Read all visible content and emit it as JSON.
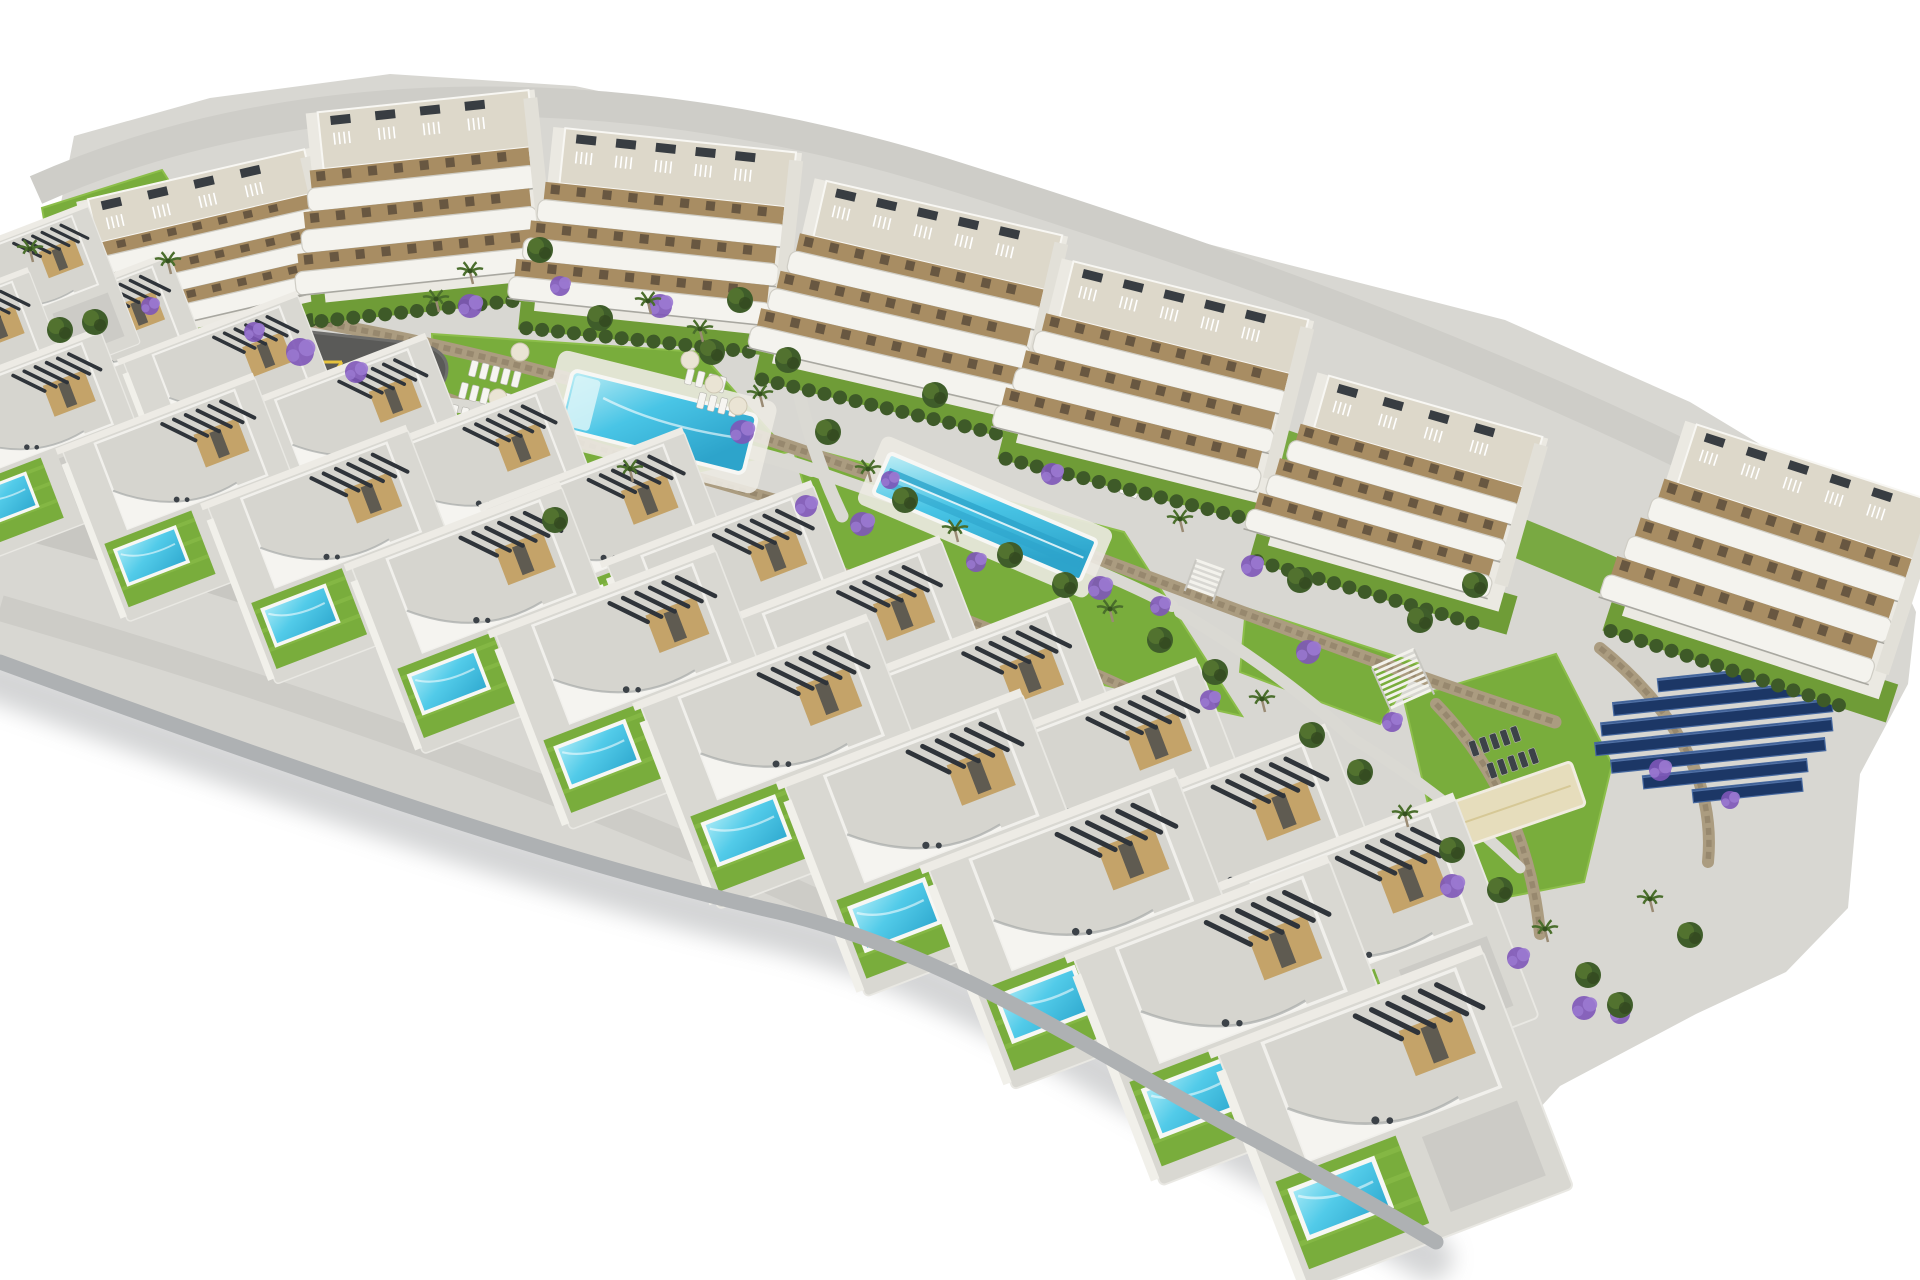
{
  "scene": {
    "width": 1920,
    "height": 1280,
    "background": "#ffffff",
    "subject": "aerial-3d-render-residential-development"
  },
  "palette": {
    "base": "#d8d7d2",
    "road": "#c8c7c2",
    "roadTop": "#cecdc8",
    "cliff": "#aeb1b3",
    "shadow": "#8f9294",
    "lawn": "#79ad3c",
    "lawnLight": "#8cbe4a",
    "lawnBand": "#74a73a",
    "hedge": "#3e5a28",
    "tree1": "#3f5d2a",
    "tree2": "#547430",
    "palm": "#4a6e2c",
    "trunk": "#9a8b74",
    "wall": "#ab9c80",
    "wallDark": "#8f8066",
    "poolRim": "#f7f7f4",
    "poolDeep": "#2da4cb",
    "purple1": "#7e57b8",
    "purple2": "#9b79d2",
    "solar": "#1c3766",
    "solarEdge": "#46689f",
    "aptWhite": "#f4f3ee",
    "terraceTan": "#a88d63",
    "roofBeige": "#ddd8ca",
    "units": "#383d42",
    "villaRoof": "#d6d5cf",
    "concrete": "#d9d8d2",
    "tan": "#c4a369",
    "pergola": "#2f343a",
    "deck": "#eceae2",
    "sand": "#e6ddbc",
    "playground": "#5a5a58",
    "playEquip": "#e6c33e"
  },
  "site": {
    "base_path": "M 0,258 L 58,218 L 74,136 L 210,98 L 390,74 L 575,86 L 790,132 L 1030,198 L 1270,260 L 1505,320 L 1690,402 L 1806,472 L 1884,542 L 1916,612 L 1908,684 L 1860,774 L 1848,908 L 1786,972 L 1696,1014 L 1560,1086 L 1470,1184 L 1436,1242 C 1396,1218 1330,1180 1252,1138 C 1108,1062 958,955 778,912 C 560,862 300,772 0,662 Z",
    "front_edge_path": "M 0,662 C 300,772 560,862 778,912 C 958,955 1108,1062 1252,1138 C 1330,1180 1396,1218 1436,1242",
    "top_road_path": "M 36,190 C 300,72 640,76 960,178 C 1260,272 1580,386 1896,566",
    "mid_road_path": "M 0,512 C 340,600 680,728 1000,894 C 1190,993 1320,1080 1418,1162",
    "front_road_path": "M 0,608 C 320,700 640,814 932,956 C 1128,1052 1298,1148 1410,1224",
    "garden_band_path": "M 60,252 C 340,218 640,252 950,330 C 1240,402 1520,508 1800,640 L 1840,706 C 1560,564 1260,452 960,372 C 660,292 360,260 92,298 Z"
  },
  "greens": [
    {
      "d": "M 42,208 L 162,170 L 212,248 L 158,312 L 58,300 Z"
    },
    {
      "d": "M 432,334 L 700,352 L 788,452 L 560,502 L 436,428 Z"
    },
    {
      "d": "M 792,444 L 1124,532 L 1242,716 L 1010,664 L 824,556 Z"
    },
    {
      "d": "M 1404,700 L 1556,654 L 1612,764 L 1584,882 L 1452,908 Z"
    },
    {
      "d": "M 1302,1122 L 1402,1078 L 1434,1180 L 1434,1240 L 1356,1192 Z"
    },
    {
      "d": "M 1246,608 L 1420,664 L 1380,724 L 1240,672 Z"
    }
  ],
  "walls": [
    {
      "d": "M 148,296 C 420,330 640,392 880,478 C 1120,564 1330,650 1555,722",
      "w": 13
    },
    {
      "d": "M 430,392 C 540,432 660,468 792,504",
      "w": 11
    },
    {
      "d": "M 806,560 C 950,610 1090,668 1215,730",
      "w": 11
    },
    {
      "d": "M 842,610 C 980,662 1110,715 1228,772",
      "w": 10
    },
    {
      "d": "M 1436,704 C 1500,770 1532,850 1540,934",
      "w": 12
    },
    {
      "d": "M 1600,648 C 1672,706 1716,780 1708,862",
      "w": 12
    }
  ],
  "paths": [
    {
      "d": "M 352,392 C 540,418 690,428 812,470",
      "w": 14
    },
    {
      "d": "M 812,470 C 940,516 1060,548 1172,606",
      "w": 12
    },
    {
      "d": "M 792,356 C 800,408 816,462 842,516",
      "w": 13
    },
    {
      "d": "M 1180,612 C 1240,648 1300,690 1352,738",
      "w": 12
    },
    {
      "d": "M 1352,738 C 1420,780 1470,820 1520,868",
      "w": 11
    }
  ],
  "apartments": [
    {
      "cx": 210,
      "cy": 248,
      "w": 240,
      "h": 150,
      "rot": -13
    },
    {
      "cx": 430,
      "cy": 196,
      "w": 230,
      "h": 190,
      "rot": -6
    },
    {
      "cx": 668,
      "cy": 232,
      "w": 250,
      "h": 185,
      "rot": 6
    },
    {
      "cx": 920,
      "cy": 300,
      "w": 260,
      "h": 190,
      "rot": 13
    },
    {
      "cx": 1165,
      "cy": 382,
      "w": 260,
      "h": 190,
      "rot": 14
    },
    {
      "cx": 1408,
      "cy": 492,
      "w": 240,
      "h": 180,
      "rot": 16
    },
    {
      "cx": 1782,
      "cy": 560,
      "w": 270,
      "h": 205,
      "rot": 18
    }
  ],
  "villas": {
    "rowA": [
      {
        "x": 105,
        "y": 355,
        "s": 0.84,
        "rot": -21,
        "car": null
      },
      {
        "x": 230,
        "y": 399,
        "s": 0.88,
        "rot": -21,
        "car": "#d9dadb"
      },
      {
        "x": 356,
        "y": 446,
        "s": 0.92,
        "rot": -21,
        "car": null
      },
      {
        "x": 482,
        "y": 496,
        "s": 0.96,
        "rot": -21,
        "car": "#3a424d"
      },
      {
        "x": 607,
        "y": 550,
        "s": 1.0,
        "rot": -21,
        "car": null
      },
      {
        "x": 733,
        "y": 608,
        "s": 1.04,
        "rot": -21,
        "car": "#6b4a33"
      },
      {
        "x": 858,
        "y": 668,
        "s": 1.08,
        "rot": -21,
        "car": null
      },
      {
        "x": 984,
        "y": 732,
        "s": 1.12,
        "rot": -21,
        "car": "#d9dadb"
      },
      {
        "x": 1109,
        "y": 800,
        "s": 1.16,
        "rot": -21,
        "car": null
      },
      {
        "x": 1235,
        "y": 871,
        "s": 1.2,
        "rot": -21,
        "car": "#2e3742"
      },
      {
        "x": 1360,
        "y": 945,
        "s": 1.24,
        "rot": -21,
        "car": null
      }
    ],
    "rowB": [
      {
        "x": 30,
        "y": 440,
        "s": 0.92,
        "rot": -21,
        "car": "#d9dadb"
      },
      {
        "x": 180,
        "y": 492,
        "s": 0.97,
        "rot": -21,
        "car": null
      },
      {
        "x": 330,
        "y": 549,
        "s": 1.01,
        "rot": -21,
        "car": "#dcdddd"
      },
      {
        "x": 480,
        "y": 612,
        "s": 1.06,
        "rot": -21,
        "car": null
      },
      {
        "x": 630,
        "y": 681,
        "s": 1.11,
        "rot": -21,
        "car": "#3a424d"
      },
      {
        "x": 780,
        "y": 755,
        "s": 1.15,
        "rot": -21,
        "car": null
      },
      {
        "x": 930,
        "y": 836,
        "s": 1.2,
        "rot": -21,
        "car": "#d9dadb"
      },
      {
        "x": 1080,
        "y": 922,
        "s": 1.25,
        "rot": -21,
        "car": null
      },
      {
        "x": 1230,
        "y": 1013,
        "s": 1.29,
        "rot": -21,
        "car": "#6b4a33"
      },
      {
        "x": 1380,
        "y": 1110,
        "s": 1.34,
        "rot": -21,
        "car": null
      }
    ],
    "extra": [
      {
        "x": 28,
        "y": 298,
        "s": 0.78,
        "rot": -21,
        "car": null
      },
      {
        "x": -34,
        "y": 368,
        "s": 0.82,
        "rot": -21,
        "car": null
      }
    ]
  },
  "pools": {
    "main": {
      "cx": 658,
      "cy": 422,
      "rot": 14,
      "deckW": 225,
      "deckH": 95,
      "poolW": 190,
      "poolH": 60
    },
    "lap": {
      "cx": 985,
      "cy": 517,
      "rot": 23,
      "deckW": 250,
      "deckH": 74,
      "poolW": 225,
      "poolH": 44
    }
  },
  "solar": {
    "x": 1722,
    "y": 672,
    "rot": -6,
    "rowH": 13,
    "rowGap": 19,
    "lens": [
      140,
      205,
      232,
      238,
      215,
      165,
      110
    ],
    "offs": [
      55,
      8,
      -6,
      -14,
      0,
      30,
      78
    ]
  },
  "playground": {
    "blob": "M 245,355 Q 250,333 292,330 L 420,344 Q 452,352 446,376 Q 436,406 378,408 L 284,398 Q 248,390 245,355 Z",
    "sand": {
      "x": 262,
      "y": 349,
      "w": 42,
      "h": 14,
      "rot": -8
    }
  },
  "petanque": {
    "cx": 1512,
    "cy": 806,
    "w": 140,
    "h": 46,
    "rot": -19
  },
  "stairs": [
    {
      "x": 1372,
      "y": 668,
      "rot": -24,
      "steps": 9,
      "len": 46
    },
    {
      "x": 1196,
      "y": 560,
      "rot": 20,
      "steps": 6,
      "len": 30
    }
  ],
  "loungers": [
    {
      "x": 472,
      "y": 360,
      "rot": 14,
      "count": 5,
      "dark": false
    },
    {
      "x": 462,
      "y": 382,
      "rot": 14,
      "count": 5,
      "dark": false
    },
    {
      "x": 452,
      "y": 404,
      "rot": 14,
      "count": 4,
      "dark": false
    },
    {
      "x": 688,
      "y": 368,
      "rot": 14,
      "count": 4,
      "dark": false
    },
    {
      "x": 700,
      "y": 392,
      "rot": 14,
      "count": 4,
      "dark": false
    },
    {
      "x": 1086,
      "y": 448,
      "rot": 20,
      "count": 4,
      "dark": false
    },
    {
      "x": 1104,
      "y": 470,
      "rot": 20,
      "count": 4,
      "dark": false
    },
    {
      "x": 1468,
      "y": 742,
      "rot": -19,
      "count": 5,
      "dark": true
    },
    {
      "x": 1486,
      "y": 764,
      "rot": -19,
      "count": 5,
      "dark": true
    }
  ],
  "parasols": [
    [
      690,
      360
    ],
    [
      714,
      384
    ],
    [
      738,
      406
    ],
    [
      520,
      352
    ],
    [
      498,
      398
    ]
  ],
  "flowers": [
    [
      300,
      352,
      14
    ],
    [
      356,
      372,
      11
    ],
    [
      254,
      332,
      10
    ],
    [
      470,
      306,
      12
    ],
    [
      560,
      286,
      10
    ],
    [
      660,
      306,
      12
    ],
    [
      742,
      432,
      12
    ],
    [
      806,
      506,
      11
    ],
    [
      862,
      524,
      12
    ],
    [
      1052,
      474,
      11
    ],
    [
      1100,
      588,
      12
    ],
    [
      1160,
      606,
      10
    ],
    [
      1252,
      566,
      11
    ],
    [
      1308,
      652,
      12
    ],
    [
      1392,
      722,
      10
    ],
    [
      1452,
      886,
      12
    ],
    [
      1518,
      958,
      11
    ],
    [
      1584,
      1008,
      12
    ],
    [
      976,
      562,
      10
    ],
    [
      890,
      480,
      9
    ],
    [
      1210,
      700,
      10
    ],
    [
      1620,
      1014,
      10
    ],
    [
      150,
      306,
      9
    ],
    [
      1660,
      770,
      11
    ],
    [
      1730,
      800,
      9
    ]
  ],
  "trees": [
    [
      168,
      262,
      "p"
    ],
    [
      95,
      322,
      "t"
    ],
    [
      60,
      330,
      "t"
    ],
    [
      30,
      250,
      "p"
    ],
    [
      436,
      300,
      "p"
    ],
    [
      470,
      272,
      "p"
    ],
    [
      540,
      250,
      "t"
    ],
    [
      600,
      318,
      "t"
    ],
    [
      648,
      302,
      "p"
    ],
    [
      700,
      330,
      "p"
    ],
    [
      712,
      352,
      "t"
    ],
    [
      760,
      395,
      "p"
    ],
    [
      788,
      360,
      "t"
    ],
    [
      828,
      432,
      "t"
    ],
    [
      868,
      470,
      "p"
    ],
    [
      905,
      500,
      "t"
    ],
    [
      955,
      530,
      "p"
    ],
    [
      1010,
      555,
      "t"
    ],
    [
      1065,
      585,
      "t"
    ],
    [
      1110,
      610,
      "p"
    ],
    [
      1160,
      640,
      "t"
    ],
    [
      1215,
      672,
      "t"
    ],
    [
      1262,
      700,
      "p"
    ],
    [
      1312,
      735,
      "t"
    ],
    [
      1360,
      772,
      "t"
    ],
    [
      1405,
      815,
      "p"
    ],
    [
      1452,
      850,
      "t"
    ],
    [
      1500,
      890,
      "t"
    ],
    [
      1545,
      930,
      "p"
    ],
    [
      1588,
      975,
      "t"
    ],
    [
      1620,
      1005,
      "t"
    ],
    [
      740,
      300,
      "t"
    ],
    [
      935,
      395,
      "t"
    ],
    [
      1180,
      520,
      "p"
    ],
    [
      1300,
      580,
      "t"
    ],
    [
      1420,
      620,
      "t"
    ],
    [
      1475,
      585,
      "t"
    ],
    [
      1650,
      900,
      "p"
    ],
    [
      1690,
      935,
      "t"
    ],
    [
      630,
      470,
      "p"
    ],
    [
      555,
      520,
      "t"
    ]
  ]
}
